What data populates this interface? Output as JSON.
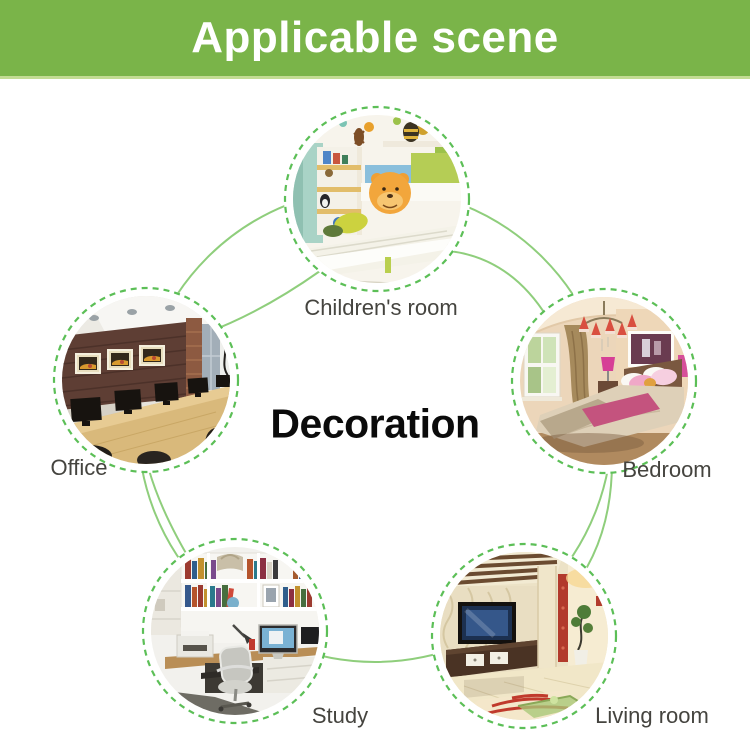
{
  "banner": {
    "title": "Applicable scene",
    "bg_color": "#7ab449",
    "text_color": "#ffffff"
  },
  "diagram": {
    "center_label": "Decoration",
    "connector_color": "#8fce7c",
    "dashed_ring_color": "#5cbf57",
    "label_color": "#45443f",
    "nodes": [
      {
        "id": "children-room",
        "label": "Children's room"
      },
      {
        "id": "bedroom",
        "label": "Bedroom"
      },
      {
        "id": "living-room",
        "label": "Living room"
      },
      {
        "id": "study",
        "label": "Study"
      },
      {
        "id": "office",
        "label": "Office"
      }
    ]
  }
}
